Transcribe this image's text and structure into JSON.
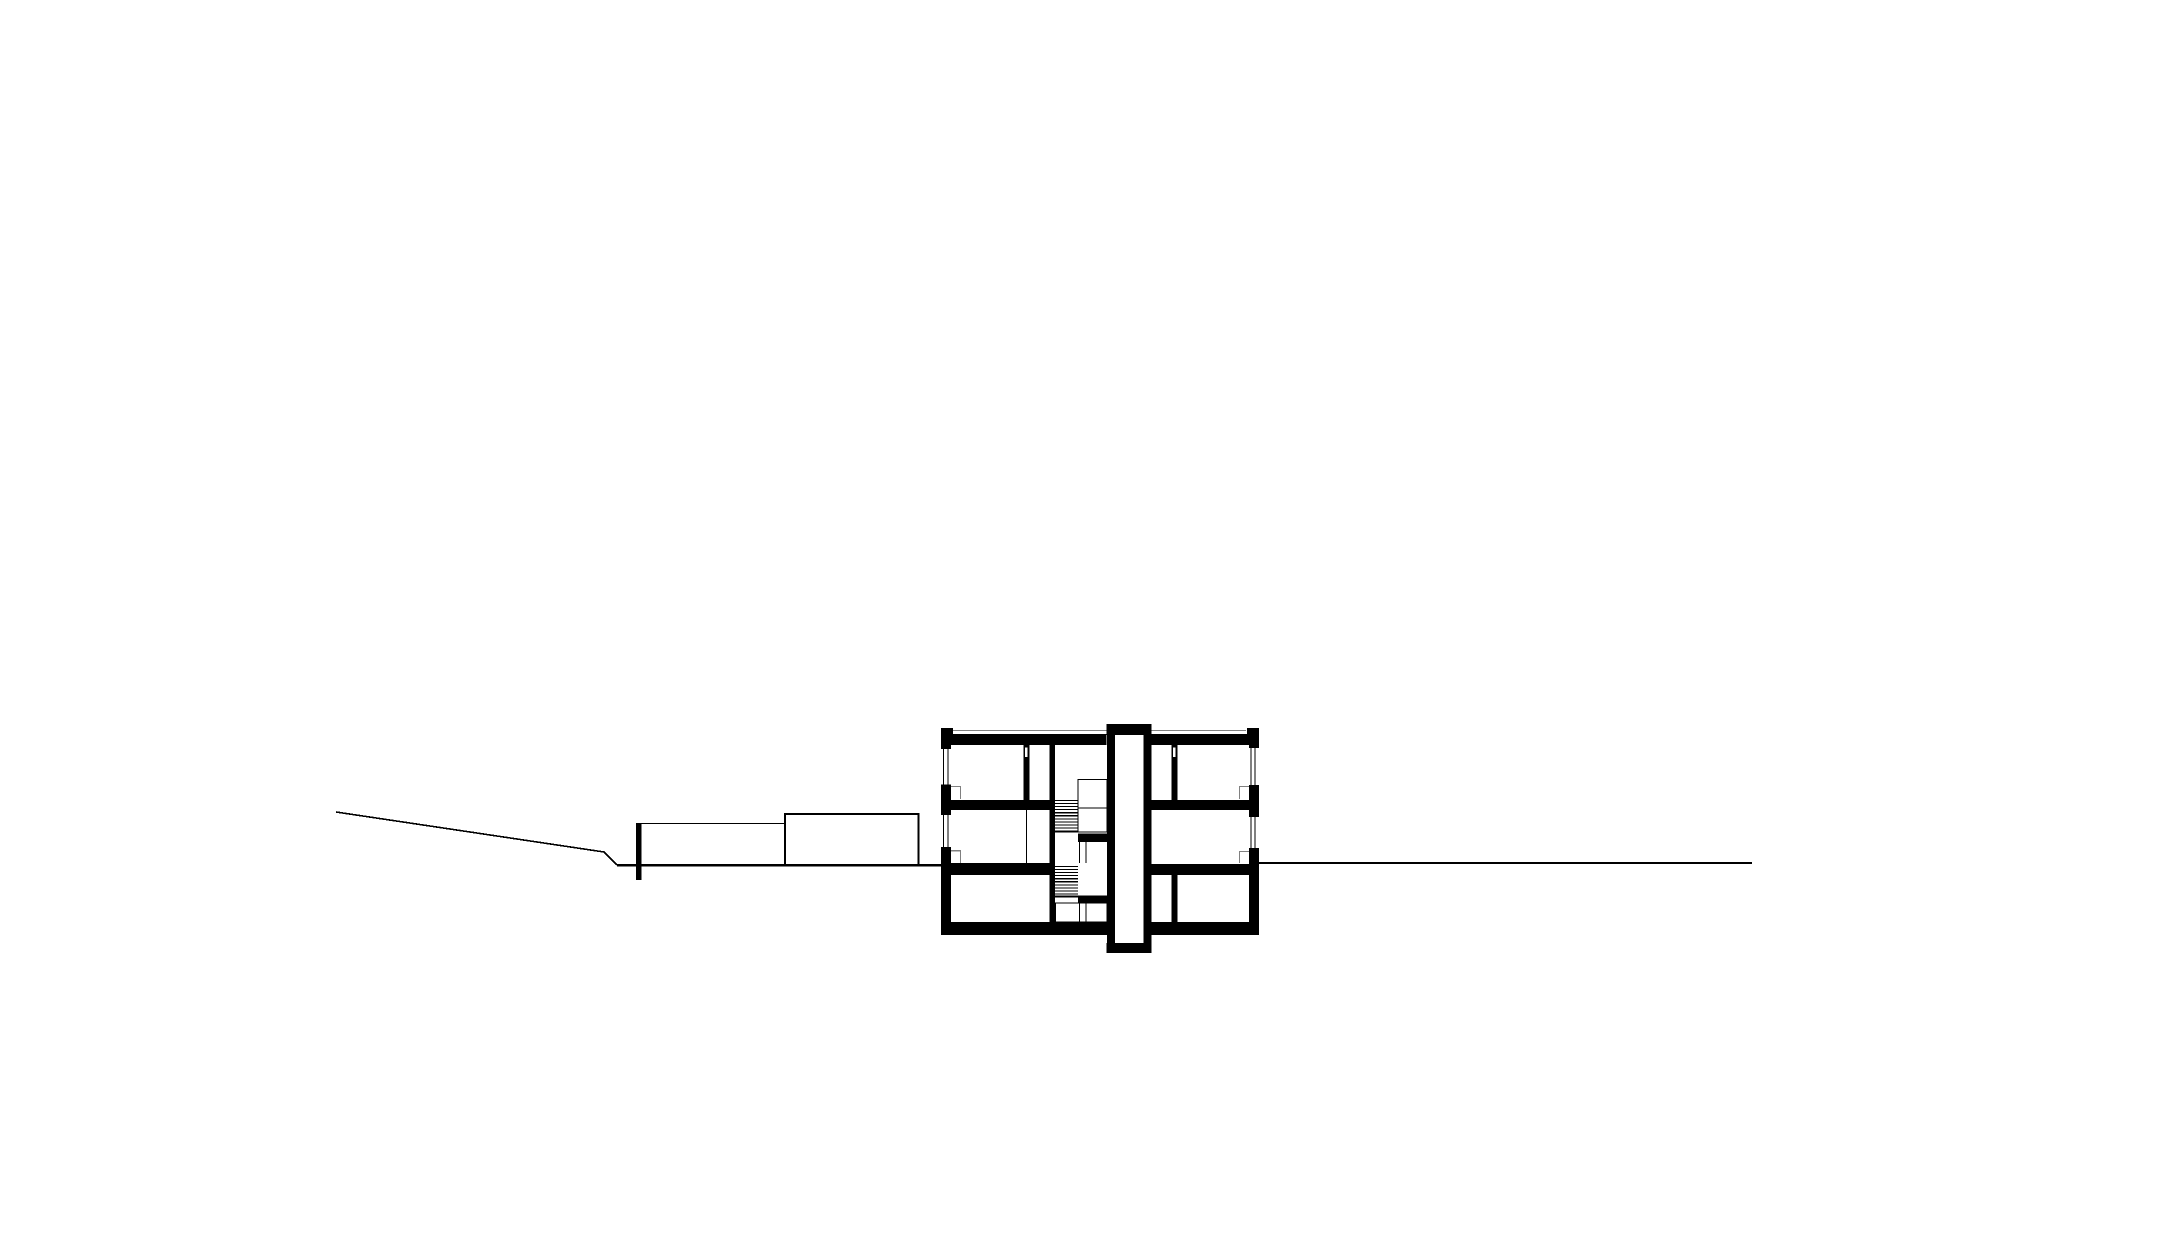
{
  "canvas": {
    "width": 2182,
    "height": 1260
  },
  "palette": {
    "paper": "#ffffff",
    "ink": "#000000",
    "detail": "#808080"
  },
  "drawing": {
    "kind": "architectural-cross-section",
    "elements": [
      {
        "name": "roof-slab-left",
        "kind": "rect",
        "x": 941,
        "y": 734,
        "w": 165.5,
        "h": 11
      },
      {
        "name": "roof-slab-right",
        "kind": "rect",
        "x": 1151.5,
        "y": 734,
        "w": 107.5,
        "h": 11
      },
      {
        "name": "parapet-block-left",
        "kind": "rect",
        "x": 941,
        "y": 728,
        "w": 12,
        "h": 17
      },
      {
        "name": "parapet-block-right",
        "kind": "rect",
        "x": 1247,
        "y": 728,
        "w": 12,
        "h": 17
      },
      {
        "name": "exterior-wall-left",
        "kind": "rect",
        "x": 941,
        "y": 745,
        "w": 10,
        "h": 190
      },
      {
        "name": "exterior-wall-right",
        "kind": "rect",
        "x": 1249,
        "y": 745,
        "w": 10,
        "h": 190
      },
      {
        "name": "foundation-slab-left",
        "kind": "rect",
        "x": 941,
        "y": 922,
        "w": 174,
        "h": 13
      },
      {
        "name": "foundation-slab-right",
        "kind": "rect",
        "x": 1143.5,
        "y": 922,
        "w": 115.5,
        "h": 13
      },
      {
        "name": "floor-slab-upper-left",
        "kind": "rect",
        "x": 951,
        "y": 800,
        "w": 104,
        "h": 10
      },
      {
        "name": "floor-slab-upper-right",
        "kind": "rect",
        "x": 1151.5,
        "y": 800,
        "w": 97.5,
        "h": 10
      },
      {
        "name": "ground-slab-left",
        "kind": "rect",
        "x": 951,
        "y": 863,
        "w": 104,
        "h": 12
      },
      {
        "name": "ground-slab-right",
        "kind": "rect",
        "x": 1151.5,
        "y": 864,
        "w": 97.5,
        "h": 11
      },
      {
        "name": "stair-core-wall",
        "kind": "rect",
        "x": 1049.5,
        "y": 745,
        "w": 5.5,
        "h": 177
      },
      {
        "name": "partition-upper-left",
        "kind": "rect",
        "x": 1023.5,
        "y": 745,
        "w": 6,
        "h": 55
      },
      {
        "name": "partition-upper-right",
        "kind": "rect",
        "x": 1171.5,
        "y": 745,
        "w": 6,
        "h": 55
      },
      {
        "name": "partition-basement-right",
        "kind": "rect",
        "x": 1171.5,
        "y": 875,
        "w": 6,
        "h": 47
      },
      {
        "name": "shaft-head",
        "kind": "rect",
        "x": 1106.5,
        "y": 724,
        "w": 45,
        "h": 11
      },
      {
        "name": "shaft-wall-left",
        "kind": "rect",
        "x": 1107,
        "y": 735,
        "w": 8,
        "h": 208
      },
      {
        "name": "shaft-wall-right",
        "kind": "rect",
        "x": 1143.5,
        "y": 735,
        "w": 8,
        "h": 208
      },
      {
        "name": "shaft-pit-slab",
        "kind": "rect",
        "x": 1106.5,
        "y": 943,
        "w": 45,
        "h": 10
      },
      {
        "name": "window-left-upper-opening",
        "kind": "rect",
        "x": 941,
        "y": 749,
        "w": 10,
        "h": 35.5,
        "fill": "paper"
      },
      {
        "name": "window-left-upper-glass-1",
        "kind": "line",
        "x1": 943.6,
        "y1": 749,
        "x2": 943.6,
        "y2": 784.5,
        "sw": 1
      },
      {
        "name": "window-left-upper-glass-2",
        "kind": "line",
        "x1": 948,
        "y1": 749,
        "x2": 948,
        "y2": 784.5,
        "sw": 1
      },
      {
        "name": "window-left-lower-opening",
        "kind": "rect",
        "x": 941,
        "y": 815,
        "w": 10,
        "h": 32,
        "fill": "paper"
      },
      {
        "name": "window-left-lower-glass-1",
        "kind": "line",
        "x1": 943.6,
        "y1": 815,
        "x2": 943.6,
        "y2": 847,
        "sw": 1
      },
      {
        "name": "window-left-lower-glass-2",
        "kind": "line",
        "x1": 948,
        "y1": 815,
        "x2": 948,
        "y2": 847,
        "sw": 1
      },
      {
        "name": "window-right-upper-opening",
        "kind": "rect",
        "x": 1249,
        "y": 748,
        "w": 10,
        "h": 37,
        "fill": "paper"
      },
      {
        "name": "window-right-upper-glass-1",
        "kind": "line",
        "x1": 1250.8,
        "y1": 748,
        "x2": 1250.8,
        "y2": 785,
        "sw": 1
      },
      {
        "name": "window-right-upper-glass-2",
        "kind": "line",
        "x1": 1255.2,
        "y1": 748,
        "x2": 1255.2,
        "y2": 785,
        "sw": 1
      },
      {
        "name": "window-right-lower-opening",
        "kind": "rect",
        "x": 1249,
        "y": 817,
        "w": 10,
        "h": 31,
        "fill": "paper"
      },
      {
        "name": "window-right-lower-glass-1",
        "kind": "line",
        "x1": 1250.8,
        "y1": 817,
        "x2": 1250.8,
        "y2": 848,
        "sw": 1
      },
      {
        "name": "window-right-lower-glass-2",
        "kind": "line",
        "x1": 1255.2,
        "y1": 817,
        "x2": 1255.2,
        "y2": 848,
        "sw": 1
      },
      {
        "name": "door-leaf-upper-left",
        "kind": "orect",
        "x": 1024.5,
        "y": 747,
        "w": 3.5,
        "h": 10.5,
        "sw": 0.9,
        "fill": "paper"
      },
      {
        "name": "door-leaf-upper-right",
        "kind": "orect",
        "x": 1172.5,
        "y": 747,
        "w": 3.5,
        "h": 10.5,
        "sw": 0.9,
        "fill": "paper"
      },
      {
        "name": "stair-upper-flight-treads",
        "kind": "treads",
        "x1": 1055,
        "x2": 1078,
        "y0": 800.5,
        "step": 3.05,
        "n": 11,
        "sw": 1.1
      },
      {
        "name": "stair-upper-landing-box",
        "kind": "orect",
        "x": 1078,
        "y": 779.5,
        "w": 29,
        "h": 52.5,
        "sw": 1.1
      },
      {
        "name": "stair-upper-landing-divider",
        "kind": "line",
        "x1": 1078,
        "y1": 808,
        "x2": 1107,
        "y2": 808,
        "sw": 1.1
      },
      {
        "name": "stair-level-line-first",
        "kind": "line",
        "x1": 1055,
        "y1": 832,
        "x2": 1107,
        "y2": 832,
        "sw": 1.1
      },
      {
        "name": "stair-half-landing-upper",
        "kind": "rect",
        "x": 1078,
        "y": 833.5,
        "w": 29,
        "h": 8
      },
      {
        "name": "stair-mid-rail-line",
        "kind": "line",
        "x1": 1078,
        "y1": 841.5,
        "x2": 1107,
        "y2": 841.5,
        "sw": 1.1
      },
      {
        "name": "stair-mid-post-1",
        "kind": "line",
        "x1": 1079.5,
        "y1": 841.5,
        "x2": 1079.5,
        "y2": 863,
        "sw": 1.1
      },
      {
        "name": "stair-mid-post-2",
        "kind": "line",
        "x1": 1086,
        "y1": 841.5,
        "x2": 1086,
        "y2": 863,
        "sw": 1.1
      },
      {
        "name": "stair-lower-flight-treads",
        "kind": "treads",
        "x1": 1055,
        "x2": 1078,
        "y0": 866.5,
        "step": 3.05,
        "n": 11,
        "sw": 1.1
      },
      {
        "name": "stair-level-line-basement",
        "kind": "line",
        "x1": 1055,
        "y1": 896,
        "x2": 1107,
        "y2": 896,
        "sw": 1.1
      },
      {
        "name": "stair-half-landing-lower",
        "kind": "rect",
        "x": 1078,
        "y": 896,
        "w": 29,
        "h": 7
      },
      {
        "name": "stair-basement-box",
        "kind": "orect",
        "x": 1055.5,
        "y": 903,
        "w": 51.5,
        "h": 19,
        "sw": 1.1
      },
      {
        "name": "stair-basement-post-1",
        "kind": "line",
        "x1": 1079.5,
        "y1": 903,
        "x2": 1079.5,
        "y2": 922,
        "sw": 1.1
      },
      {
        "name": "stair-basement-post-2",
        "kind": "line",
        "x1": 1086,
        "y1": 903,
        "x2": 1086,
        "y2": 922,
        "sw": 1.1
      },
      {
        "name": "partition-middle-left-thin",
        "kind": "line",
        "x1": 1026.5,
        "y1": 810,
        "x2": 1026.5,
        "y2": 863,
        "sw": 1.4
      },
      {
        "name": "roof-edge-line-left",
        "kind": "line",
        "x1": 953,
        "y1": 730.5,
        "x2": 1106.5,
        "y2": 730.5,
        "sw": 1.2,
        "stroke": "detail"
      },
      {
        "name": "roof-edge-line-right",
        "kind": "line",
        "x1": 1151.5,
        "y1": 730.5,
        "x2": 1246,
        "y2": 730.5,
        "sw": 1.2,
        "stroke": "detail"
      },
      {
        "name": "window-reveal-left-upper",
        "kind": "path",
        "d": "M951,786.5 L960.5,786.5 L960.5,799",
        "sw": 1.2,
        "stroke": "detail"
      },
      {
        "name": "window-reveal-left-lower",
        "kind": "path",
        "d": "M951,850.8 L960.5,850.8 L960.5,863",
        "sw": 1.2,
        "stroke": "detail"
      },
      {
        "name": "window-reveal-right-upper",
        "kind": "path",
        "d": "M1249,786.5 L1239.5,786.5 L1239.5,799",
        "sw": 1.2,
        "stroke": "detail"
      },
      {
        "name": "window-reveal-right-lower",
        "kind": "path",
        "d": "M1249,851.5 L1239.5,851.5 L1239.5,863",
        "sw": 1.2,
        "stroke": "detail"
      },
      {
        "name": "terrain-slope-line",
        "kind": "polyline",
        "points": [
          [
            336,
            812
          ],
          [
            604,
            852
          ],
          [
            617,
            865
          ]
        ],
        "sw": 1.6
      },
      {
        "name": "terrain-cut-line-left",
        "kind": "line",
        "x1": 617,
        "y1": 865.3,
        "x2": 941,
        "y2": 865.3,
        "sw": 2.8
      },
      {
        "name": "terrain-line-right",
        "kind": "line",
        "x1": 1259,
        "y1": 863,
        "x2": 1752,
        "y2": 863,
        "sw": 1.8
      },
      {
        "name": "retaining-wall",
        "kind": "rect",
        "x": 636,
        "y": 823,
        "w": 5.5,
        "h": 57
      },
      {
        "name": "annex-roof-line",
        "kind": "line",
        "x1": 641.5,
        "y1": 823.5,
        "x2": 785,
        "y2": 823.5,
        "sw": 1.3
      },
      {
        "name": "annex-outline",
        "kind": "orect",
        "x": 785,
        "y": 814,
        "w": 133.5,
        "h": 51.5,
        "sw": 1.6
      }
    ]
  }
}
